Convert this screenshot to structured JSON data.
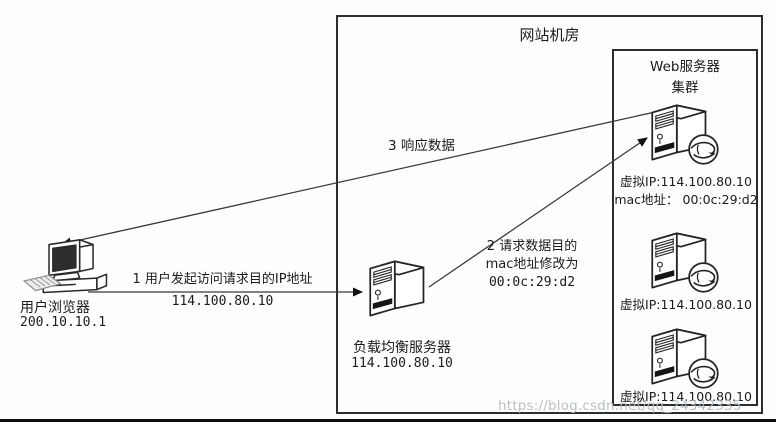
{
  "page": {
    "watermark": "https://blog.csdn.net/qq_24342335"
  },
  "datacenter": {
    "title": "网站机房"
  },
  "user_client": {
    "name": "用户浏览器",
    "ip": "200.10.10.1"
  },
  "load_balancer": {
    "name": "负载均衡服务器",
    "ip": "114.100.80.10"
  },
  "web_cluster": {
    "title_line1": "Web服务器",
    "title_line2": "集群",
    "servers": [
      {
        "virtual_ip": "虚拟IP:114.100.80.10",
        "mac": "mac地址： 00:0c:29:d2"
      },
      {
        "virtual_ip": "虚拟IP:114.100.80.10"
      },
      {
        "virtual_ip": "虚拟IP:114.100.80.10"
      }
    ]
  },
  "flows": {
    "step1_line1": "1 用户发起访问请求目的IP地址",
    "step1_line2": "114.100.80.10",
    "step2_line1": "2 请求数据目的",
    "step2_line2": "mac地址修改为",
    "step2_line3": "00:0c:29:d2",
    "step3": "3 响应数据"
  }
}
